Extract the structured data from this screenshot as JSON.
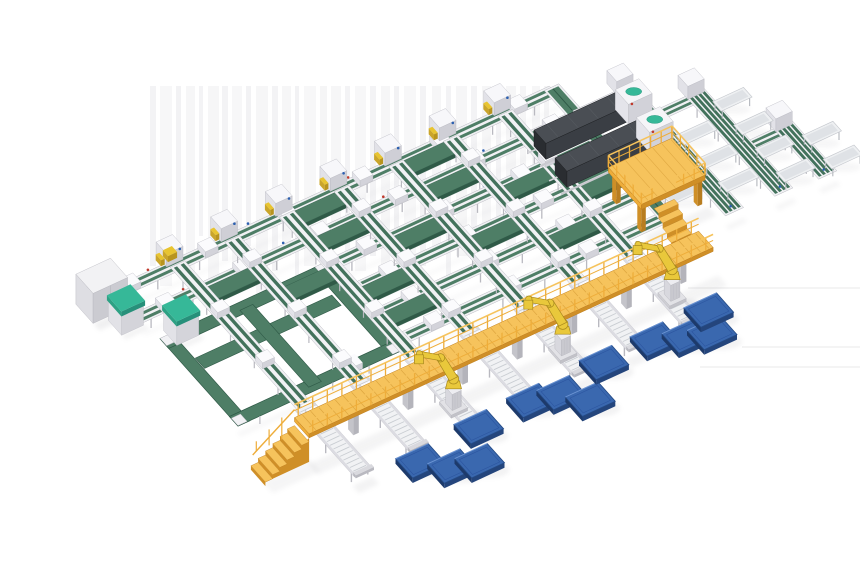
{
  "scene": {
    "description": "isometric-factory-sorting-line-render",
    "projection": {
      "ox": 85,
      "oy": 300,
      "ux": 0.91,
      "uy": -0.42,
      "vx": 0.66,
      "vy": 0.74
    },
    "colors": {
      "background": "#ffffff",
      "belt_green": "#4e7e66",
      "belt_green_dark": "#2f5a47",
      "belt_stripe": "#43725c",
      "teal": "#36b898",
      "frame_light": "#f1f1f4",
      "frame_mid": "#d9d9de",
      "frame_dark": "#b9b9c0",
      "walkway_top": "#f6c35c",
      "walkway_mid": "#eead3a",
      "walkway_dark": "#cf8f27",
      "robot_yellow": "#e9c83b",
      "robot_dark": "#a8891e",
      "pallet_top": "#3a68af",
      "pallet_side": "#24457c",
      "pallet_edge": "#6a93d4",
      "machine_top": "#4a4e54",
      "machine_side": "#2a2d31",
      "machine_front": "#3a3e44",
      "shadow": "#8a8a92",
      "streak": "#e8e8eb",
      "accent_red": "#c0392b",
      "accent_blue": "#2b5fb0",
      "accent_yellow": "#e8c430"
    },
    "background_streaks": [
      [
        150,
        6,
        180,
        0.5
      ],
      [
        160,
        12,
        200,
        0.35
      ],
      [
        176,
        5,
        165,
        0.55
      ],
      [
        186,
        9,
        190,
        0.4
      ],
      [
        199,
        4,
        150,
        0.5
      ],
      [
        208,
        11,
        205,
        0.38
      ],
      [
        222,
        6,
        175,
        0.5
      ],
      [
        232,
        10,
        195,
        0.35
      ],
      [
        246,
        5,
        160,
        0.55
      ],
      [
        256,
        12,
        210,
        0.4
      ],
      [
        272,
        6,
        185,
        0.5
      ],
      [
        282,
        9,
        170,
        0.38
      ],
      [
        295,
        4,
        200,
        0.55
      ],
      [
        304,
        12,
        180,
        0.35
      ],
      [
        320,
        7,
        195,
        0.45
      ],
      [
        331,
        10,
        160,
        0.38
      ],
      [
        345,
        5,
        205,
        0.5
      ],
      [
        355,
        11,
        185,
        0.35
      ],
      [
        370,
        6,
        170,
        0.5
      ],
      [
        381,
        9,
        195,
        0.4
      ],
      [
        394,
        5,
        155,
        0.55
      ],
      [
        404,
        12,
        200,
        0.35
      ],
      [
        420,
        6,
        180,
        0.5
      ],
      [
        432,
        9,
        160,
        0.4
      ],
      [
        446,
        5,
        190,
        0.5
      ],
      [
        456,
        11,
        170,
        0.38
      ],
      [
        471,
        6,
        150,
        0.5
      ],
      [
        482,
        9,
        175,
        0.4
      ],
      [
        496,
        5,
        140,
        0.5
      ],
      [
        506,
        10,
        160,
        0.38
      ],
      [
        520,
        6,
        130,
        0.45
      ],
      [
        532,
        8,
        120,
        0.4
      ],
      [
        544,
        5,
        100,
        0.45
      ]
    ],
    "background_lines": [
      [
        688,
        860,
        288
      ],
      [
        742,
        860,
        347
      ],
      [
        700,
        860,
        367
      ]
    ],
    "transport_lines": [
      [
        10,
        8,
        503
      ],
      [
        44,
        22,
        503
      ],
      [
        78,
        218,
        503
      ],
      [
        112,
        218,
        503
      ],
      [
        146,
        218,
        503
      ],
      [
        180,
        218,
        503
      ]
    ],
    "sorting_lines": {
      "a_positions": [
        90,
        150,
        210,
        270,
        330,
        390,
        450
      ],
      "b_start": 16,
      "b_end": 245
    },
    "crossover_belts": [
      [
        27,
        216,
        268
      ],
      [
        27,
        336,
        388
      ],
      [
        61,
        96,
        148
      ],
      [
        61,
        216,
        268
      ],
      [
        61,
        336,
        388
      ],
      [
        61,
        456,
        500
      ],
      [
        95,
        152,
        204
      ],
      [
        95,
        272,
        324
      ],
      [
        95,
        392,
        444
      ],
      [
        129,
        216,
        268
      ],
      [
        129,
        336,
        388
      ],
      [
        129,
        456,
        500
      ],
      [
        163,
        216,
        268
      ],
      [
        163,
        392,
        444
      ]
    ],
    "collector_line": {
      "a": 504,
      "b_start": 12,
      "b_end": 238
    },
    "loop": {
      "a0": 26,
      "b0": 78,
      "a1": 206,
      "b1": 196,
      "belt_width": 13
    },
    "walkway": {
      "a0": 62,
      "a1": 506,
      "b0": 232,
      "b1": 254,
      "deck_z": 24,
      "stair_steps": 6
    },
    "roller_outfeeds": {
      "a_positions": [
        90,
        150,
        210,
        270,
        330,
        390,
        450
      ],
      "b_start": 208,
      "b_end": 298
    },
    "robots": [
      [
        212,
        266
      ],
      [
        335,
        262
      ],
      [
        458,
        258
      ]
    ],
    "pallets": [
      [
        146,
        307
      ],
      [
        167,
        326
      ],
      [
        192,
        333
      ],
      [
        215,
        300
      ],
      [
        274,
        298
      ],
      [
        303,
        304
      ],
      [
        321,
        323
      ],
      [
        357,
        294
      ],
      [
        413,
        294
      ],
      [
        440,
        305
      ],
      [
        462,
        313
      ],
      [
        475,
        290
      ]
    ],
    "machines": [
      [
        455,
        545,
        62
      ],
      [
        452,
        542,
        98
      ]
    ],
    "platform": {
      "a0": 478,
      "b0": 134,
      "a1": 548,
      "b1": 184,
      "deck_z": 26
    },
    "outfeed_lines": [
      [
        560,
        44,
        212
      ],
      [
        612,
        80,
        215
      ],
      [
        658,
        150,
        218
      ]
    ],
    "outfeed_connectors": [
      [
        44,
        504,
        556
      ],
      [
        80,
        560,
        608
      ],
      [
        150,
        616,
        654
      ]
    ],
    "outfeed_tables": [
      {
        "a0": 516,
        "a1": 552,
        "rows": [
          100,
          132,
          164
        ]
      },
      {
        "a0": 568,
        "a1": 604,
        "rows": [
          112,
          144,
          176
        ]
      },
      {
        "a0": 620,
        "a1": 654,
        "rows": [
          96,
          128,
          160,
          192
        ]
      },
      {
        "a0": 666,
        "a1": 700,
        "rows": [
          168,
          200
        ]
      }
    ],
    "cabinets": {
      "gray": [
        -10,
        0,
        28,
        26,
        30
      ],
      "teal": [
        [
          4,
          30
        ],
        [
          40,
          64
        ]
      ],
      "yellow_box": [
        84,
        2
      ]
    }
  }
}
